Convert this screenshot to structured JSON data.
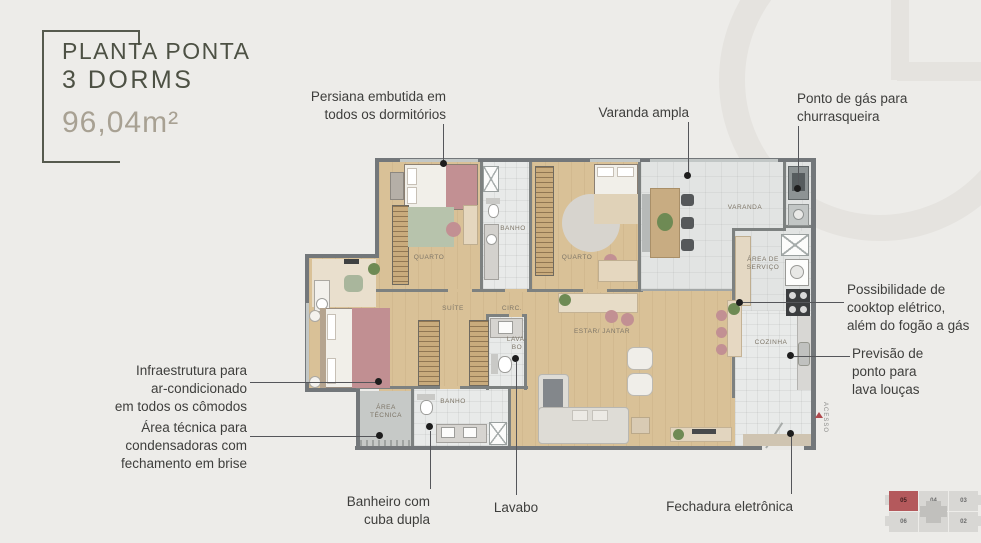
{
  "title": {
    "line1": "PLANTA PONTA",
    "line2": "3 DORMS",
    "area": "96,04m²"
  },
  "callouts": {
    "persiana": "Persiana embutida em\ntodos os dormitórios",
    "varanda_ampla": "Varanda ampla",
    "gas": "Ponto de gás para\nchurrasqueira",
    "cooktop": "Possibilidade de\ncooktop elétrico,\nalém do fogão a gás",
    "lava_loucas": "Previsão de\nponto para\nlava louças",
    "ar_condicionado": "Infraestrutura para\nar-condicionado\nem todos os cômodos",
    "area_tecnica": "Área técnica para\ncondensadoras com\nfechamento em brise",
    "banheiro": "Banheiro com\ncuba dupla",
    "lavabo": "Lavabo",
    "fechadura": "Fechadura eletrônica"
  },
  "rooms": {
    "quarto1": "QUARTO",
    "banho1": "BANHO",
    "quarto2": "QUARTO",
    "varanda": "VARANDA",
    "area_servico": "ÁREA DE\nSERVIÇO",
    "cozinha": "COZINHA",
    "suite": "SUÍTE",
    "circ": "CIRC.",
    "lavabo": "LAVA-\nBO",
    "estar": "ESTAR/ JANTAR",
    "banho2": "BANHO",
    "area_tecnica": "ÁREA\nTÉCNICA",
    "acesso": "ACESSO"
  },
  "keyplan": {
    "units": [
      "05",
      "04",
      "03",
      "06",
      "01",
      "02"
    ],
    "highlighted": "05"
  },
  "colors": {
    "accent_red": "#b4595c",
    "title_green": "#4d5144",
    "area_gray": "#a8a193"
  }
}
